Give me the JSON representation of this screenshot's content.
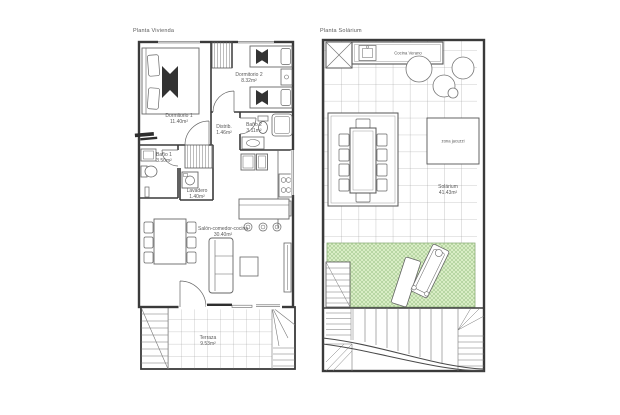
{
  "colors": {
    "wall": "#3a3a3a",
    "furniture": "#666666",
    "grid": "#b8b8b8",
    "green_fill": "#d9edc5",
    "green_hatch": "#86b571",
    "text": "#5a5a5a"
  },
  "plans": {
    "vivienda": {
      "title": "Planta Vivienda",
      "rooms": [
        {
          "name": "Dormitorio 1",
          "area": "11.40m²"
        },
        {
          "name": "Dormitorio 2",
          "area": "8.32m²"
        },
        {
          "name": "Distrib.",
          "area": "1.46m²"
        },
        {
          "name": "Baño 2",
          "area": "3.11m²"
        },
        {
          "name": "Baño 1",
          "area": "3.50m²"
        },
        {
          "name": "Lavadero",
          "area": "1.40m²"
        },
        {
          "name": "Salón-comedor-cocina",
          "area": "30.40m²"
        },
        {
          "name": "Terraza",
          "area": "9.53m²"
        }
      ]
    },
    "solarium": {
      "title": "Planta Solárium",
      "rooms": [
        {
          "name": "Cocina Verano",
          "area": ""
        },
        {
          "name": "zona jacuzzi",
          "area": ""
        },
        {
          "name": "Solárium",
          "area": "41.43m²"
        }
      ]
    }
  }
}
